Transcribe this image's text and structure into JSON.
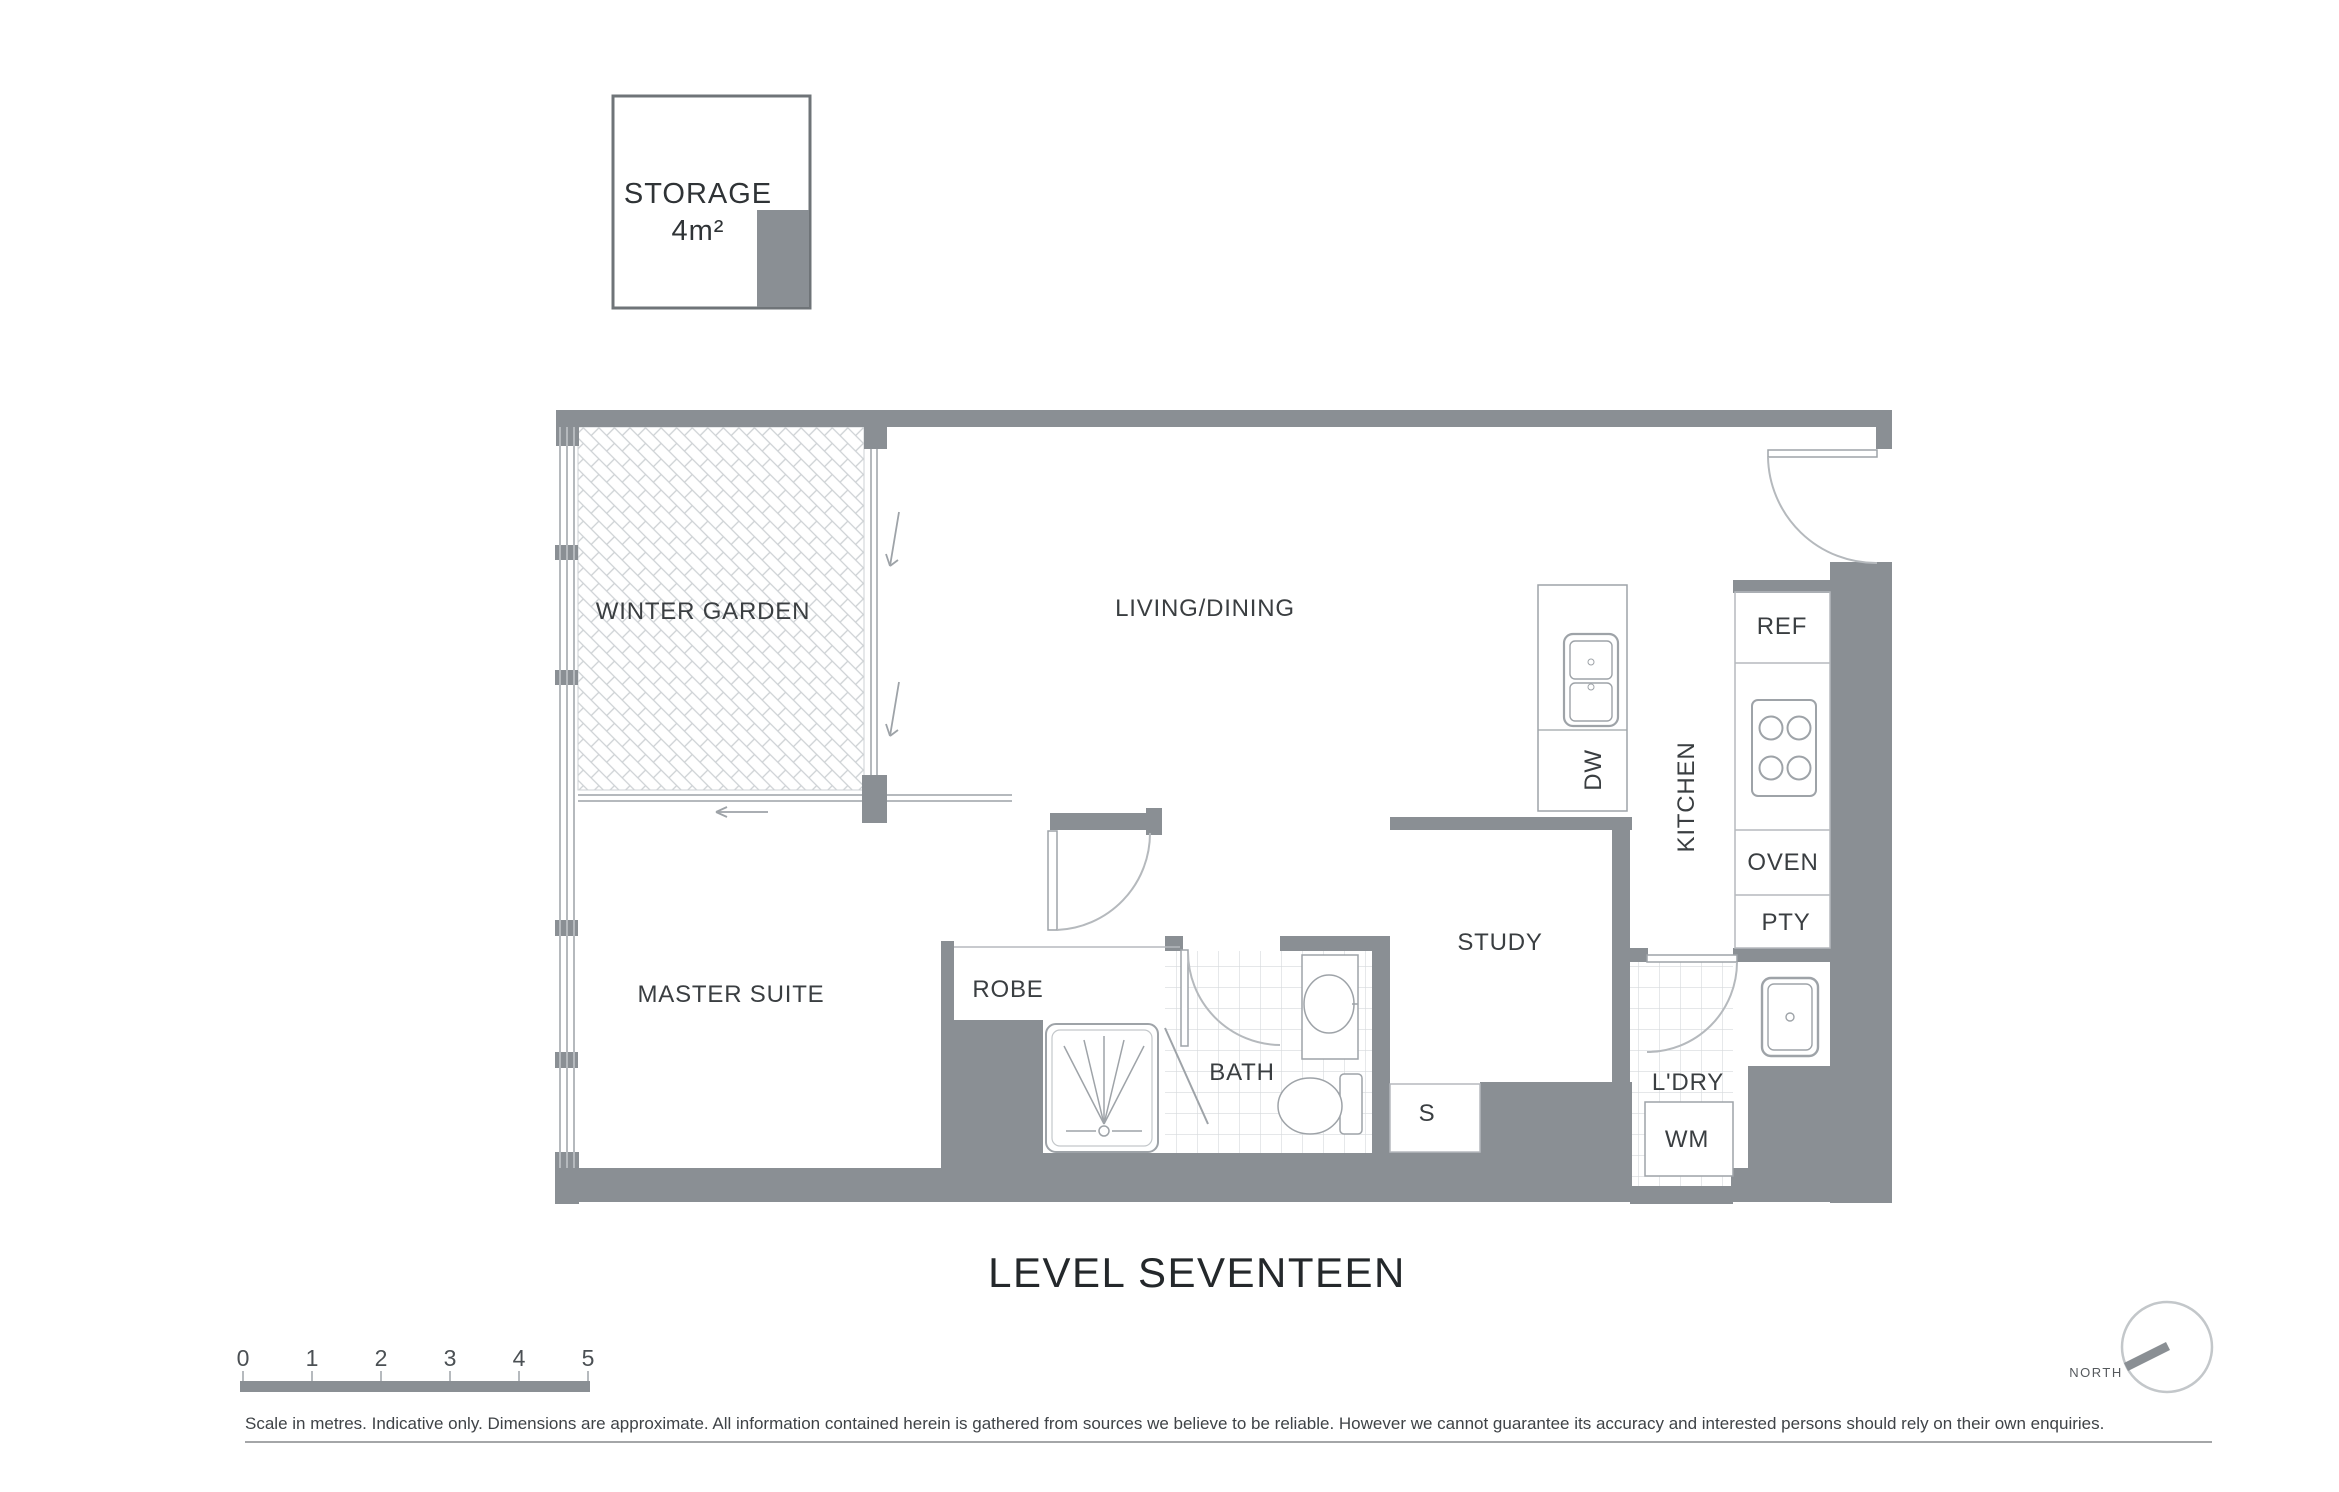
{
  "title": "LEVEL SEVENTEEN",
  "storage_box": {
    "label": "STORAGE",
    "area": "4m²"
  },
  "plan": {
    "rooms": {
      "winter_garden": "WINTER GARDEN",
      "living_dining": "LIVING/DINING",
      "master_suite": "MASTER SUITE",
      "robe": "ROBE",
      "bath": "BATH",
      "study": "STUDY",
      "storage_s": "S",
      "laundry": "L'DRY",
      "kitchen": "KITCHEN"
    },
    "appliances": {
      "wm": "WM",
      "dw": "DW",
      "ref": "REF",
      "oven": "OVEN",
      "pty": "PTY"
    }
  },
  "scale_bar": {
    "ticks": [
      "0",
      "1",
      "2",
      "3",
      "4",
      "5"
    ]
  },
  "compass": {
    "label": "NORTH"
  },
  "disclaimer": "Scale in metres. Indicative only. Dimensions are approximate. All information contained herein is gathered from sources we believe to be reliable. However we cannot guarantee its accuracy and interested persons should rely on their own enquiries.",
  "colors": {
    "wall": "#8a8f94",
    "fixture_line": "#9ea3a8",
    "light_line": "#b5b9bd",
    "tile_line": "#d6d9dc",
    "hatch_line": "#cdd1d4",
    "text": "#3a3e41",
    "title_text": "#24282b"
  }
}
